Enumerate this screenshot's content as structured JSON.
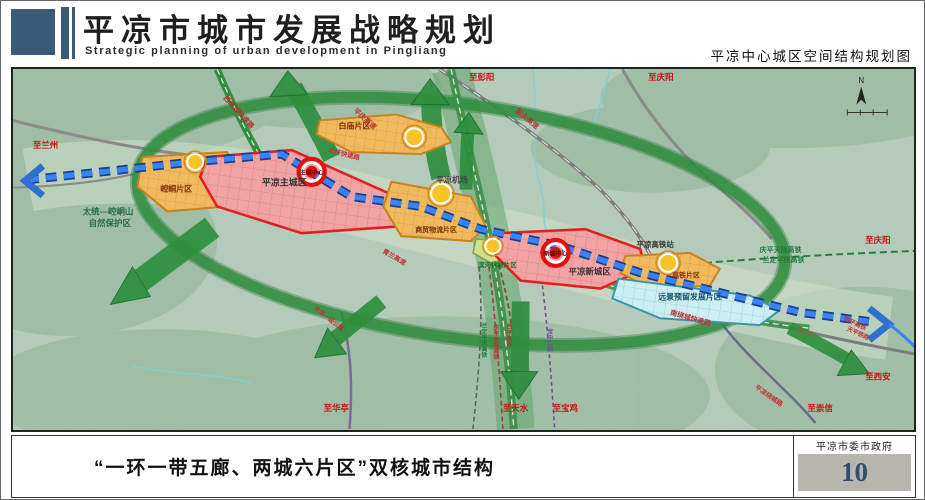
{
  "header": {
    "title": "平凉市城市发展战略规划",
    "subtitle_en": "Strategic planning of urban development in Pingliang",
    "map_title": "平凉中心城区空间结构规划图"
  },
  "footer": {
    "caption": "“一环一带五廊、两城六片区”双核城市结构",
    "agency": "平凉市委市政府",
    "page_number": "10"
  },
  "map": {
    "colors": {
      "header_blue": "#3b5a78",
      "page_number_blue": "#2f4d6e",
      "belt_blue": "#2f6fd0",
      "corridor_green": "#2e8f3e",
      "zone_red": "#e02020",
      "zone_orange": "#d98f2b",
      "reserved_blue": "#3a93ab"
    },
    "labels": {
      "to_lanzhou": "至兰州",
      "nature_reserve_line1": "太统—崆峒山",
      "nature_reserve_line2": "自然保护区",
      "kongtong_district": "崆峒片区",
      "west_ring_expwy": "西绕城快速路",
      "baimiao_district": "白庙片区",
      "pingqing_expwy": "平庆高速",
      "north_ring_expwy": "北环快速路",
      "main_city": "平凉主城区",
      "main_city_center": "主城中心",
      "pengda_expwy": "彭大高速",
      "to_pengyang": "至彭阳",
      "to_qingyang_top": "至庆阳",
      "airport": "平凉机场",
      "trade_logistics_district": "商贸物流片区",
      "qinglan_expwy": "青兰高速",
      "leisure_district": "滨河休憩片区",
      "new_city": "平凉新城区",
      "new_city_center": "新城中心",
      "hsr_station": "平凉高铁站",
      "hsr_district": "高铁片区",
      "reserved_district": "远景预留发展片区",
      "south_ring_expwy": "南绕城快速路",
      "qingping_tianlong_hsr": "庆平天陇高铁",
      "landing_pingqing_hsr": "兰定平庆高铁",
      "to_qingyang_right": "至庆阳",
      "g312": "G312",
      "xiping_hsr": "西平高铁",
      "tianping_railway": "天平铁路",
      "to_xian": "至西安",
      "to_chongxin": "至崇信",
      "pingliang_ring_road": "平凉绕城路",
      "to_huating": "至华亭",
      "to_tianshui": "至天水",
      "to_baoji": "至宝鸡",
      "v_landing_pingqing": "兰定平庆高铁",
      "v_qingping_tianlong": "庆平天陇高铁",
      "v_xiping": "西平高铁",
      "v_baozhong": "宝中二线",
      "pinghua_road": "平华一级公路",
      "compass_n": "N"
    }
  }
}
